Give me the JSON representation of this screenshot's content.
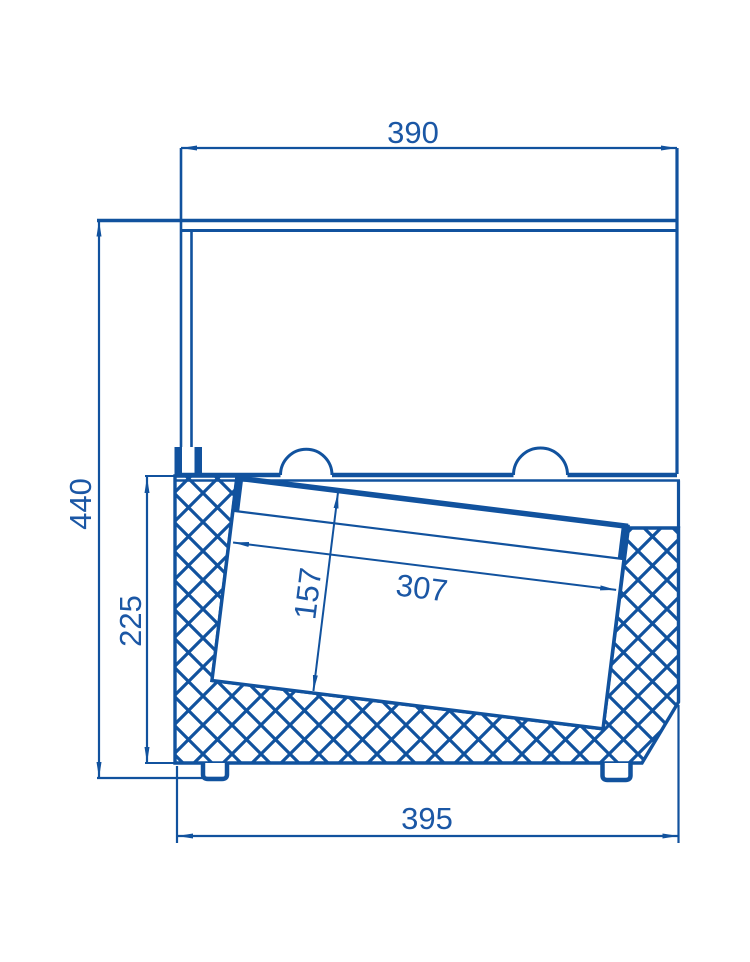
{
  "drawing": {
    "title": "refrigerated-counter-cross-section",
    "units": "mm",
    "colors": {
      "line_blue": "#11529e",
      "text_blue": "#1b57a5",
      "background": "#ffffff"
    },
    "dimensions": {
      "top_width": "390",
      "overall_height": "440",
      "body_height": "225",
      "pan_depth": "157",
      "pan_top_width": "307",
      "body_width": "395"
    }
  }
}
